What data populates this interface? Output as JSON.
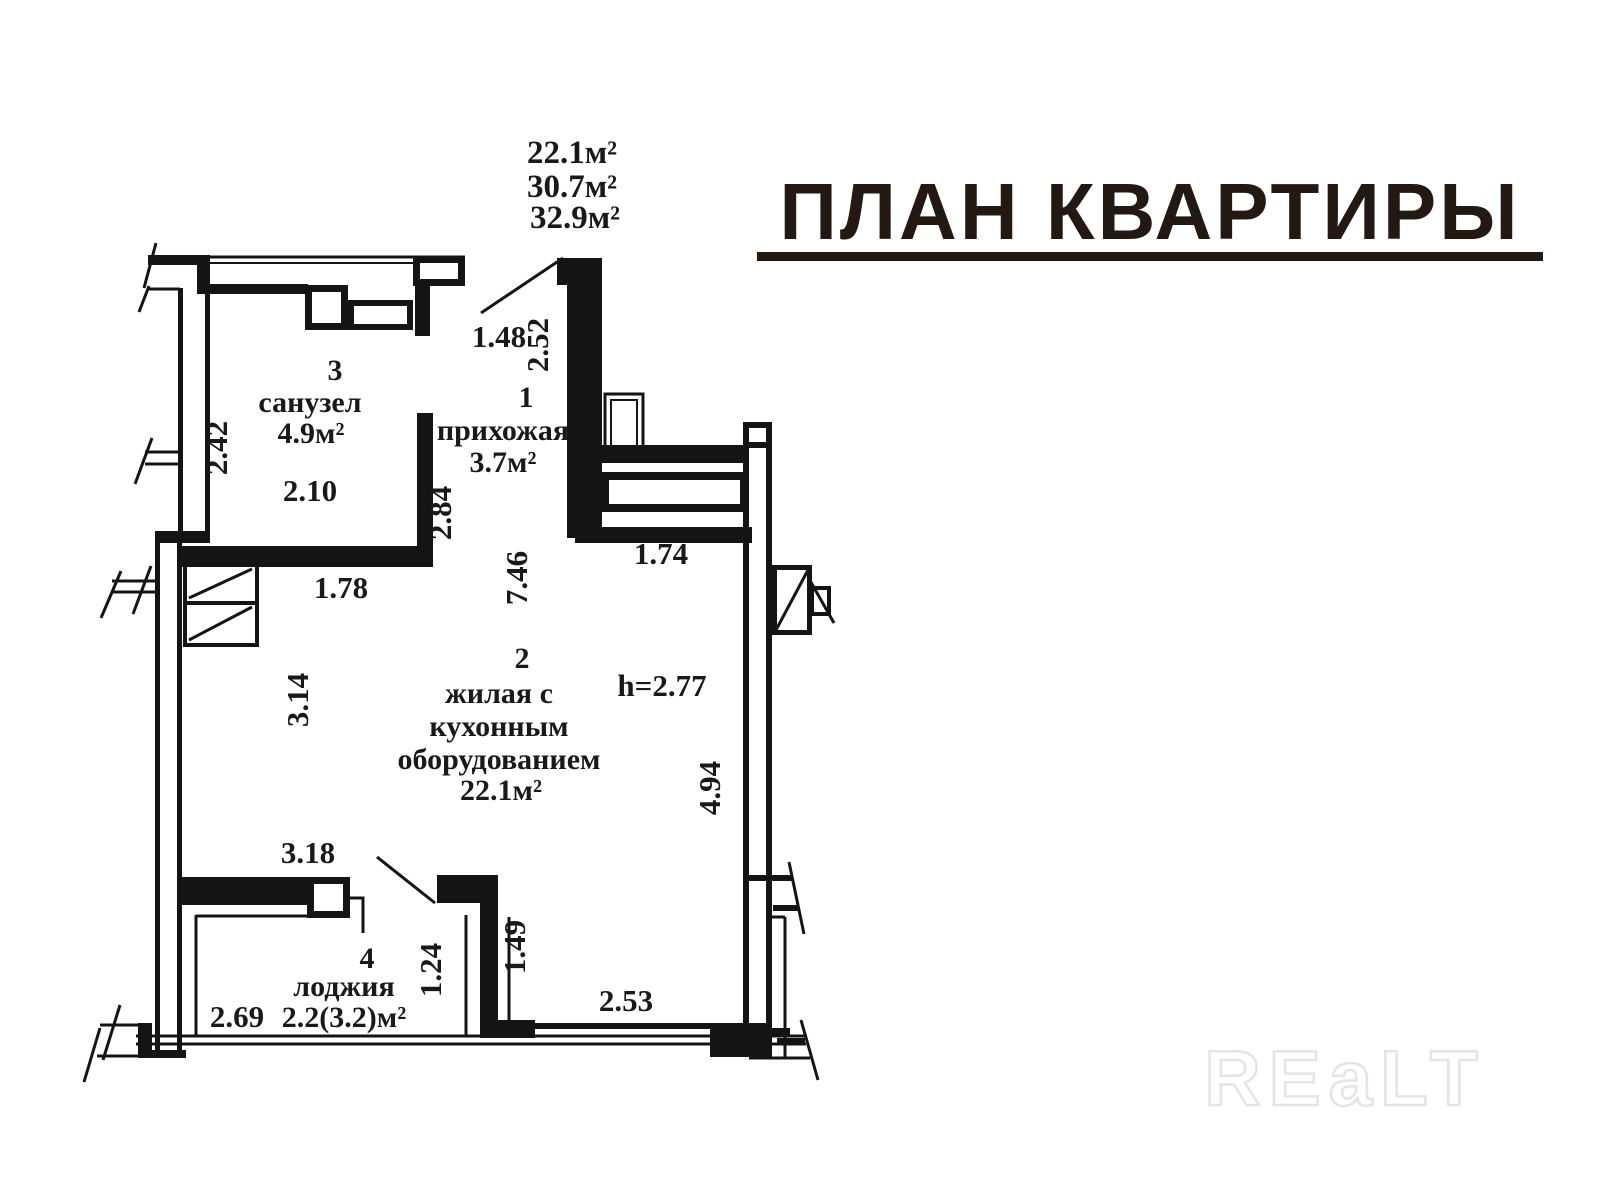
{
  "title": {
    "text": "ПЛАН КВАРТИРЫ"
  },
  "watermark": {
    "text": "REaLT"
  },
  "summary": {
    "lines": [
      "22.1м²",
      "30.7м²",
      "32.9м²"
    ]
  },
  "rooms": {
    "bathroom": {
      "number": "3",
      "name": "санузел",
      "area": "4.9м²"
    },
    "hallway": {
      "number": "1",
      "name": "прихожая",
      "area": "3.7м²"
    },
    "living": {
      "number": "2",
      "line1": "жилая с",
      "line2": "кухонным",
      "line3": "оборудованием",
      "area": "22.1м²"
    },
    "loggia": {
      "number": "4",
      "name": "лоджия",
      "area": "2.2(3.2)м²"
    }
  },
  "notes": {
    "height": "h=2.77"
  },
  "dims": {
    "d148": "1.48",
    "d252": "2.52",
    "d242": "2.42",
    "d210": "2.10",
    "d284": "2.84",
    "d178": "1.78",
    "d746": "7.46",
    "d174": "1.74",
    "d314": "3.14",
    "d494": "4.94",
    "d318": "3.18",
    "d269": "2.69",
    "d124": "1.24",
    "d149": "1.49",
    "d253": "2.53"
  }
}
